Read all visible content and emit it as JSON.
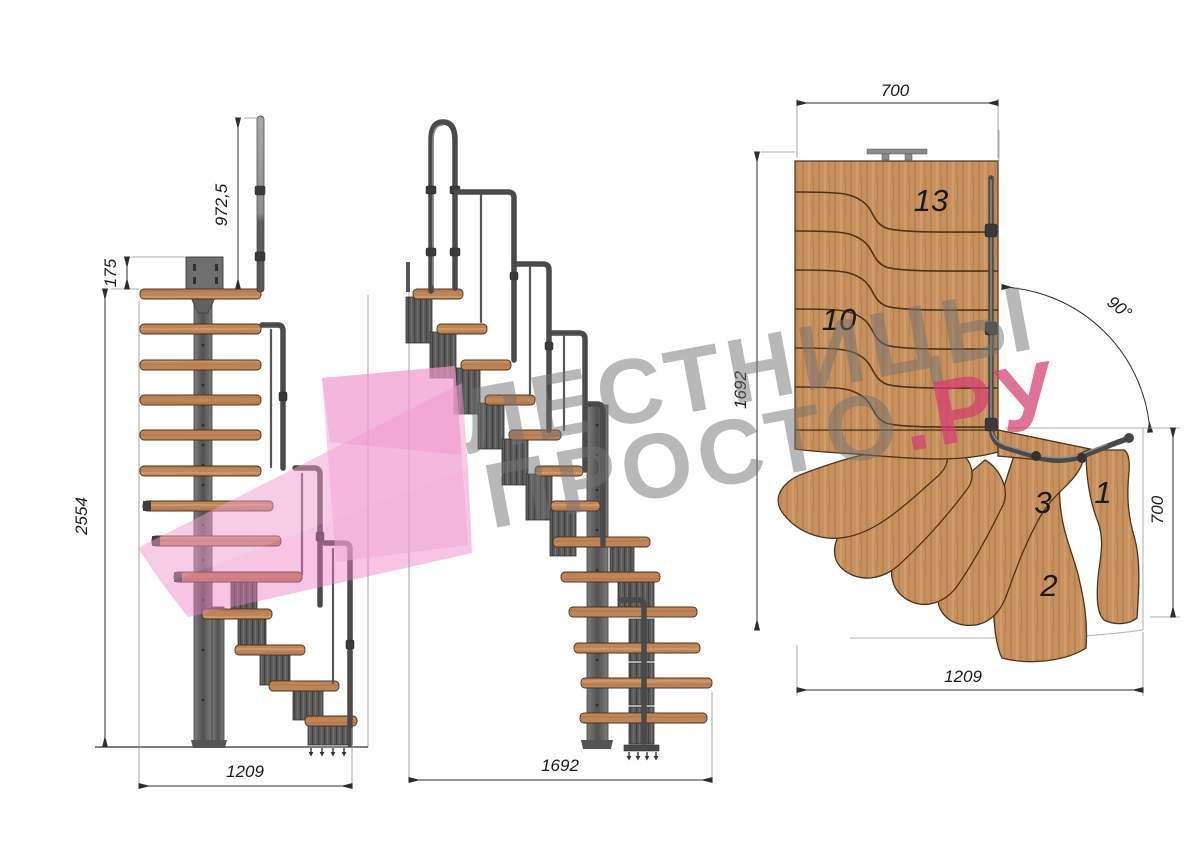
{
  "watermark": {
    "line1": "ЛЕСТНИЦЫ",
    "line2_main": "ПРОСТО",
    "line2_accent": ".РУ",
    "text_color": "#737373",
    "accent_color": "#d63c72",
    "logo_color": "#f0a0d2"
  },
  "side_view": {
    "dim_rail_height": "972,5",
    "dim_plate_offset": "175",
    "dim_total_height": "2554",
    "dim_total_run": "1209"
  },
  "front_view": {
    "dim_total_run": "1692"
  },
  "plan_view": {
    "dim_top_width": "700",
    "dim_left_length": "1692",
    "dim_turn_angle": "90°",
    "dim_right_width": "700",
    "dim_bottom_length": "1209",
    "step_labels": {
      "top": "13",
      "middle": "10",
      "s3": "3",
      "s1": "1",
      "s2": "2"
    },
    "wood_color": "#c6915e",
    "steel_color": "#555555"
  }
}
